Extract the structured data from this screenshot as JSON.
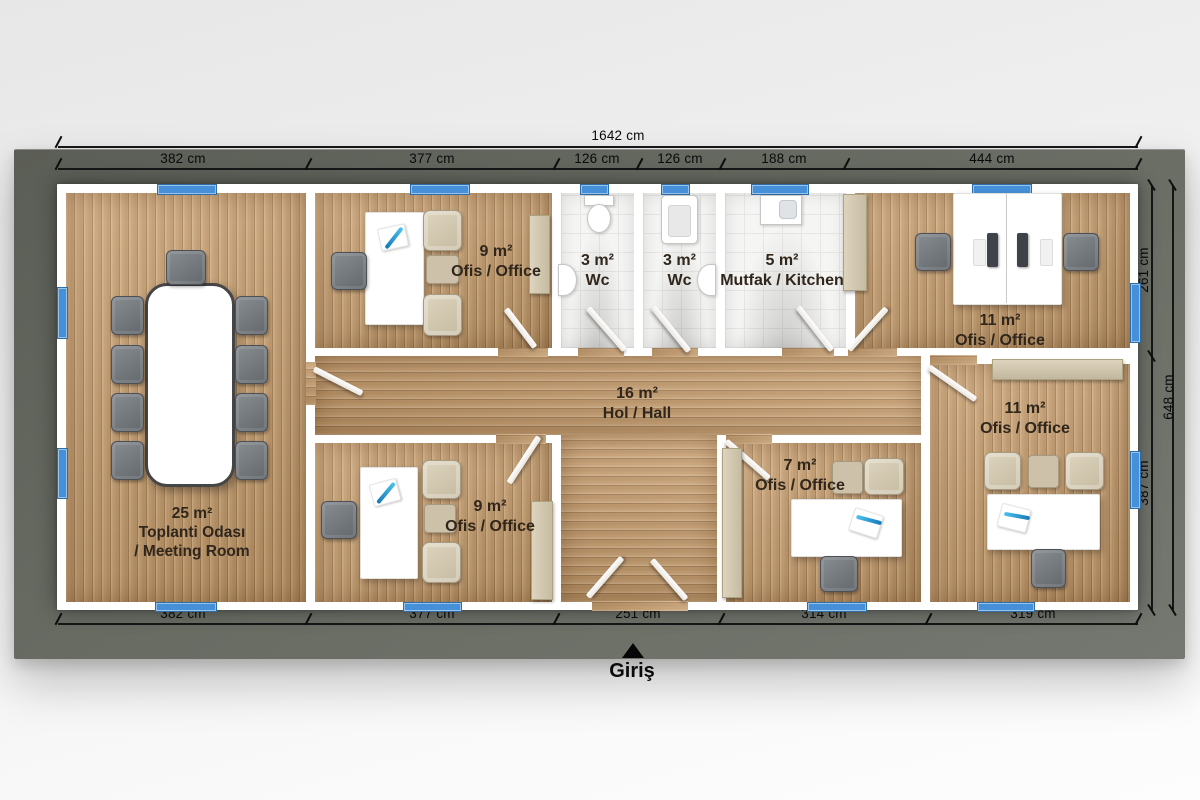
{
  "plan": {
    "type": "office_floor_plan",
    "dims": {
      "total_top": "1642 cm",
      "top": [
        "382 cm",
        "377 cm",
        "126 cm",
        "126 cm",
        "188 cm",
        "444 cm"
      ],
      "bottom": [
        "382 cm",
        "377 cm",
        "251 cm",
        "314 cm",
        "319 cm"
      ],
      "right": [
        "261 cm",
        "387 cm"
      ],
      "right_total": "648 cm"
    },
    "entrance": {
      "label": "Giriş",
      "marker": "up-triangle"
    },
    "rooms": [
      {
        "id": "meeting-room",
        "area": "25 m²",
        "name": "Toplanti Odası",
        "name2": "/ Meeting Room"
      },
      {
        "id": "office-top",
        "area": "9 m²",
        "name": "Ofis / Office"
      },
      {
        "id": "wc-1",
        "area": "3 m²",
        "name": "Wc"
      },
      {
        "id": "wc-2",
        "area": "3 m²",
        "name": "Wc"
      },
      {
        "id": "kitchen",
        "area": "5 m²",
        "name": "Mutfak / Kitchen"
      },
      {
        "id": "office-top-right",
        "area": "11 m²",
        "name": "Ofis / Office"
      },
      {
        "id": "hall",
        "area": "16 m²",
        "name": "Hol / Hall"
      },
      {
        "id": "office-bottom",
        "area": "9 m²",
        "name": "Ofis / Office"
      },
      {
        "id": "office-7",
        "area": "7 m²",
        "name": "Ofis / Office"
      },
      {
        "id": "office-bottom-right",
        "area": "11 m²",
        "name": "Ofis / Office"
      }
    ],
    "colors": {
      "window_blue": "#4590d8",
      "deck_gray": "#666a61",
      "wood_floor": "#c79e6e",
      "wall_white": "#ffffff",
      "tile_white": "#f5f5f4",
      "label_brown": "#30261b",
      "dimension_black": "#111111"
    }
  }
}
